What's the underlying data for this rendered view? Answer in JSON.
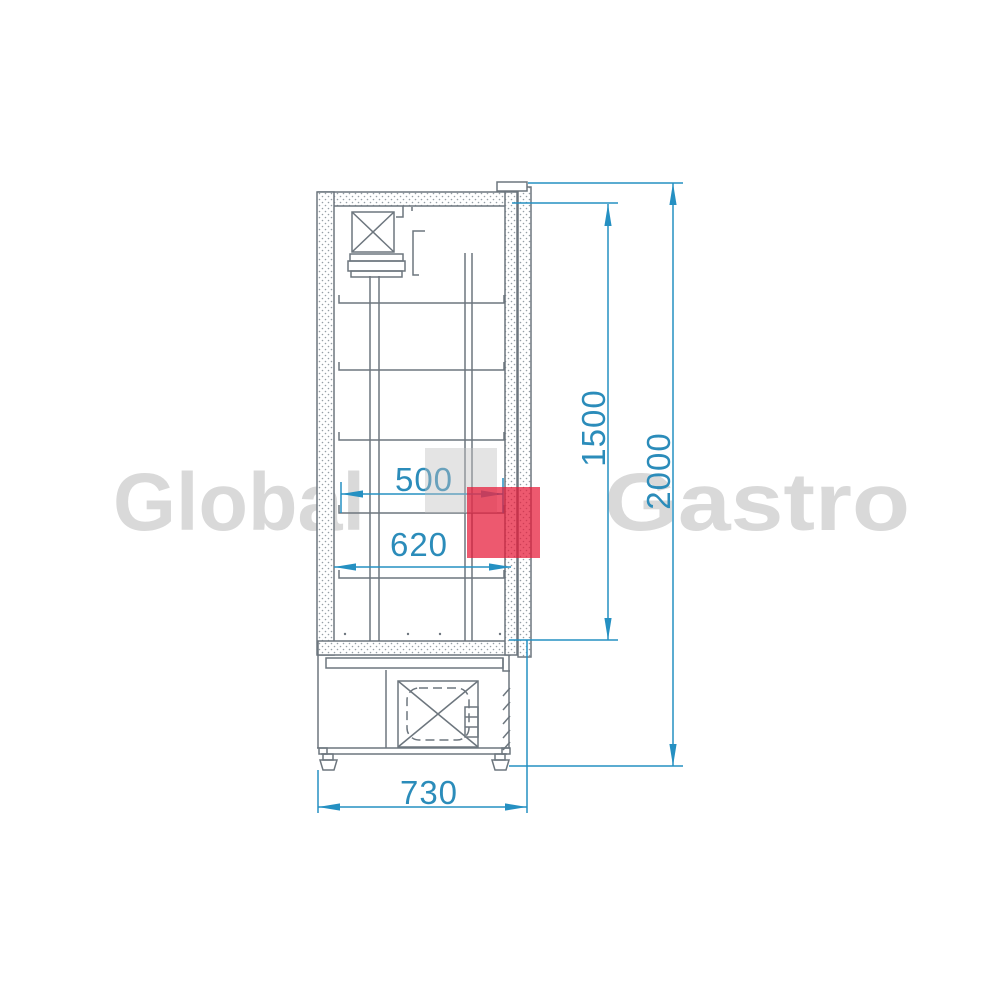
{
  "image": {
    "kind": "technical line drawing",
    "subject": "refrigerated cabinet side view with dimensions"
  },
  "watermark": {
    "word_left": "Global",
    "word_right": "Gastro",
    "text_color": "#d9d9d9",
    "logo_gray_square_color": "#e4e4e4",
    "logo_red_square_color": "#ed596f"
  },
  "drawing": {
    "line_color": "#6d767e",
    "dimension_color": "#2590c2",
    "dimension_text_color": "#2b8cba",
    "dimensions": [
      {
        "id": "shelf-depth",
        "value": "500",
        "orientation": "horizontal"
      },
      {
        "id": "inner-depth",
        "value": "620",
        "orientation": "horizontal"
      },
      {
        "id": "overall-depth",
        "value": "730",
        "orientation": "horizontal"
      },
      {
        "id": "inner-height",
        "value": "1500",
        "orientation": "vertical"
      },
      {
        "id": "overall-height",
        "value": "2000",
        "orientation": "vertical"
      }
    ]
  }
}
